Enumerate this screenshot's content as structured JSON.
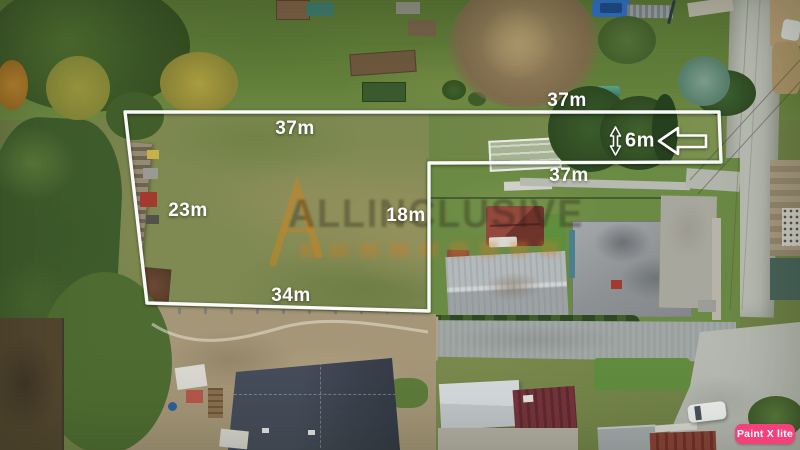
{
  "image": {
    "type": "aerial-drone-photo",
    "subject": "residential land plot outlined in white with dimension annotations"
  },
  "measurements": {
    "plot_top": "37m",
    "plot_left": "23m",
    "plot_bottom": "34m",
    "inner_divider": "18m",
    "strip_top": "37m",
    "strip_bottom": "37m",
    "strip_width": "6m"
  },
  "annotations": {
    "boundary_color": "#ffffff",
    "boundary_points": [
      [
        125,
        112
      ],
      [
        719,
        112
      ],
      [
        721,
        162
      ],
      [
        429,
        163
      ],
      [
        429,
        311
      ],
      [
        147,
        303
      ]
    ],
    "direction_arrow": "left",
    "width_arrow": "vertical-double"
  },
  "watermark": {
    "text": "ALLINCLUSIVE",
    "logo_color": "#cd831d"
  },
  "badge": {
    "label": "Paint X lite",
    "bg_color": "#f4417c",
    "text_color": "#ffffff"
  }
}
